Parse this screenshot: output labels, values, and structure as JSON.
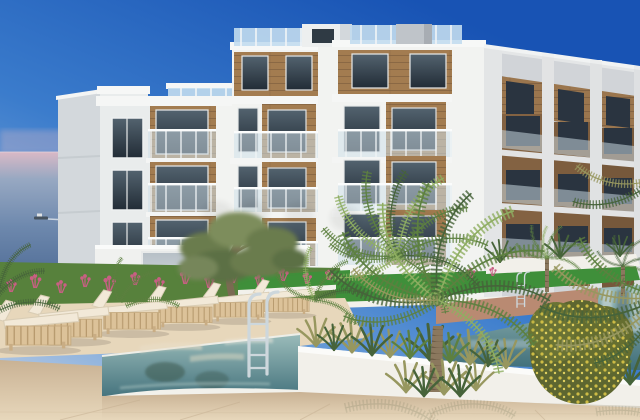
{
  "image": {
    "alt": "3D architectural rendering of a modern white apartment residence with wooden cladding, glass balconies and rooftop terraces overlooking the sea; in the foreground a communal swimming pool with chrome ladders, a row of cream sun loungers on a stone deck, palm trees, an olive tree, ornamental grasses and pink flowering shrubs under a clear blue sky, a small boat on the water to the left"
  },
  "watermark": {
    "present": true,
    "legible": false
  },
  "scene": {
    "colors": {
      "sky_deep": "#1853b4",
      "sky_mid": "#3b7ccc",
      "sky_pale": "#c9d4e6",
      "haze_pink": "#d9b9c6",
      "sea_far": "#97a8c2",
      "sea_mid": "#6d88ad",
      "sea_deep": "#44618c",
      "wall_sunlit": "#f2f3f1",
      "wall_white": "#e9ecec",
      "wall_shadow": "#d3d8dc",
      "wood": "#a37c50",
      "wood_dark": "#7e5f3e",
      "window_glass": "#2b3641",
      "balustrade_glass": "#cfe0ea",
      "roof_glass": "#c2dcee",
      "lawn": "#57813c",
      "lawn_bright": "#3f8f3a",
      "flower_pink": "#c95f84",
      "olive_green": "#6b7c4e",
      "palm_green": "#5d8040",
      "palm_light": "#8fae62",
      "palm_dark": "#46633a",
      "grass_olive": "#97975f",
      "trunk_brown": "#8b785e",
      "deck_sand": "#d9c3a6",
      "deck_light": "#e7d7bb",
      "pool_teal": "#3f6e79",
      "pool_teal_light": "#9bbcba",
      "coping_white": "#f2f1eb",
      "planter_white": "#f2f0ea",
      "terracotta": "#b98a72",
      "cushion_cream": "#f2e9d8",
      "lounger_wood": "#dcc299",
      "ladder_chrome": "#cdd7dc",
      "shrub_yellow": "#cdbc45"
    }
  }
}
